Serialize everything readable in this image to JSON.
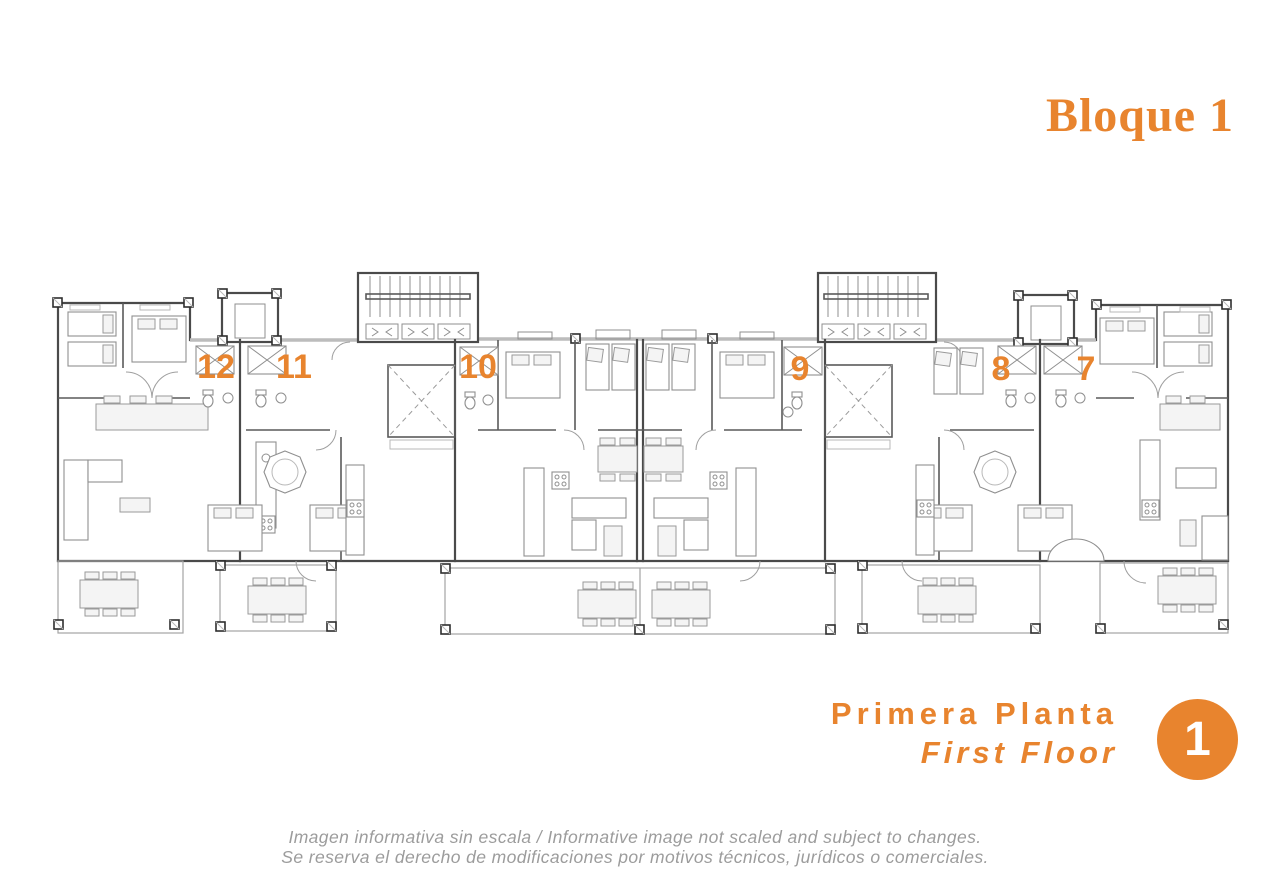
{
  "theme": {
    "accent": "#E8842E",
    "disclaimer_color": "#9C9C9C"
  },
  "header": {
    "block_title": "Bloque 1"
  },
  "plan": {
    "units": [
      {
        "number": "12"
      },
      {
        "number": "11"
      },
      {
        "number": "10"
      },
      {
        "number": "9"
      },
      {
        "number": "8"
      },
      {
        "number": "7"
      }
    ]
  },
  "footer": {
    "floor_name_es": "Primera Planta",
    "floor_name_en": "First Floor",
    "floor_number": "1"
  },
  "disclaimer": {
    "line1": "Imagen informativa sin escala /  Informative image not scaled and subject to changes.",
    "line2": "Se reserva el derecho de modificaciones por motivos técnicos, jurídicos o comerciales."
  }
}
